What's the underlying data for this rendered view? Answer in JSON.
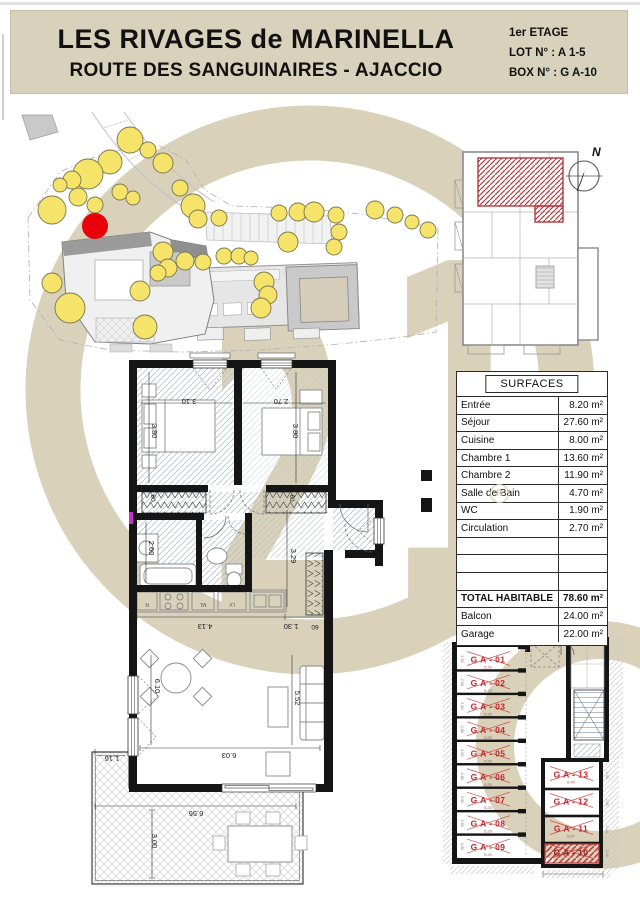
{
  "header": {
    "title_line1": "LES RIVAGES de MARINELLA",
    "title_line2": "ROUTE DES SANGUINAIRES - AJACCIO",
    "floor": "1er ETAGE",
    "lot": "LOT N° : A 1-5",
    "box": "BOX N° : G A-10"
  },
  "watermark": {
    "digits": "21",
    "registered": "R",
    "color": "#d9d1ba"
  },
  "key_plan": {
    "north": "N"
  },
  "surfaces_table": {
    "title": "SURFACES",
    "rows": [
      {
        "label": "Entrée",
        "value": "8.20 m²"
      },
      {
        "label": "Séjour",
        "value": "27.60 m²"
      },
      {
        "label": "Cuisine",
        "value": "8.00 m²"
      },
      {
        "label": "Chambre 1",
        "value": "13.60 m²"
      },
      {
        "label": "Chambre 2",
        "value": "11.90 m²"
      },
      {
        "label": "Salle de Bain",
        "value": "4.70 m²"
      },
      {
        "label": "WC",
        "value": "1.90 m²"
      },
      {
        "label": "Circulation",
        "value": "2.70 m²"
      },
      {
        "label": "",
        "value": ""
      },
      {
        "label": "",
        "value": ""
      },
      {
        "label": "",
        "value": ""
      },
      {
        "label": "TOTAL HABITABLE",
        "value": "78.60 m²",
        "bold": true
      },
      {
        "label": "Balcon",
        "value": "24.00 m²"
      },
      {
        "label": "Garage",
        "value": "22.00 m²"
      }
    ]
  },
  "floor_plan": {
    "dimensions": [
      {
        "text": "3.10",
        "x": 189,
        "y": 399,
        "rot": 180
      },
      {
        "text": "2.70",
        "x": 281,
        "y": 399,
        "rot": 180
      },
      {
        "text": "3.80",
        "x": 152,
        "y": 431,
        "rot": 90
      },
      {
        "text": "3.80",
        "x": 293,
        "y": 431,
        "rot": 90
      },
      {
        "text": "60",
        "x": 151,
        "y": 498,
        "rot": 90,
        "s": 6.5
      },
      {
        "text": "60",
        "x": 290,
        "y": 498,
        "rot": 90,
        "s": 6.5
      },
      {
        "text": "2.60",
        "x": 149,
        "y": 548,
        "rot": 90
      },
      {
        "text": "3.29",
        "x": 291,
        "y": 556,
        "rot": 90
      },
      {
        "text": "4.13",
        "x": 205,
        "y": 624,
        "rot": 180
      },
      {
        "text": "1.30",
        "x": 291,
        "y": 624,
        "rot": 180
      },
      {
        "text": "60",
        "x": 315,
        "y": 625,
        "rot": 180,
        "s": 6.5
      },
      {
        "text": "6.10",
        "x": 155,
        "y": 686,
        "rot": 90
      },
      {
        "text": "5.52",
        "x": 295,
        "y": 698,
        "rot": 90
      },
      {
        "text": "6.03",
        "x": 229,
        "y": 753,
        "rot": 180
      },
      {
        "text": "1.16",
        "x": 112,
        "y": 756,
        "rot": 180
      },
      {
        "text": "6.56",
        "x": 196,
        "y": 811,
        "rot": 180
      },
      {
        "text": "3.00",
        "x": 152,
        "y": 841,
        "rot": 90
      }
    ],
    "kitchen_labels": [
      {
        "text": "R",
        "x": 147,
        "y": 603
      },
      {
        "text": "ML",
        "x": 203,
        "y": 603
      },
      {
        "text": "LV",
        "x": 232,
        "y": 603
      }
    ]
  },
  "garage_plan": {
    "left_stalls": [
      {
        "label": "G A - 01",
        "dim": "5.20"
      },
      {
        "label": "G A - 02",
        "dim": "5.20"
      },
      {
        "label": "G A - 03",
        "dim": "5.20"
      },
      {
        "label": "G A - 04",
        "dim": "5.20"
      },
      {
        "label": "G A - 05",
        "dim": "5.20"
      },
      {
        "label": "G A - 06",
        "dim": "5.20"
      },
      {
        "label": "G A - 07",
        "dim": "5.20"
      },
      {
        "label": "G A - 08",
        "dim": "5.20"
      },
      {
        "label": "G A - 09",
        "dim": "5.20"
      }
    ],
    "right_stalls": [
      {
        "label": "G A - 13",
        "dim": "6.40"
      },
      {
        "label": "G A - 12",
        "dim": ""
      },
      {
        "label": "G A - 11",
        "dim": "6.87"
      },
      {
        "label": "G A - 10",
        "dim": "",
        "highlighted": true
      }
    ]
  },
  "colors": {
    "header_bg": "#d8d1bc",
    "watermark": "#d9d1ba",
    "tree_fill": "#f6e36a",
    "marker_red": "#e8000b",
    "garage_label_red": "#c0272d",
    "hatch_red": "#b5383d",
    "floor_hatch_blue": "#a9c4da"
  }
}
